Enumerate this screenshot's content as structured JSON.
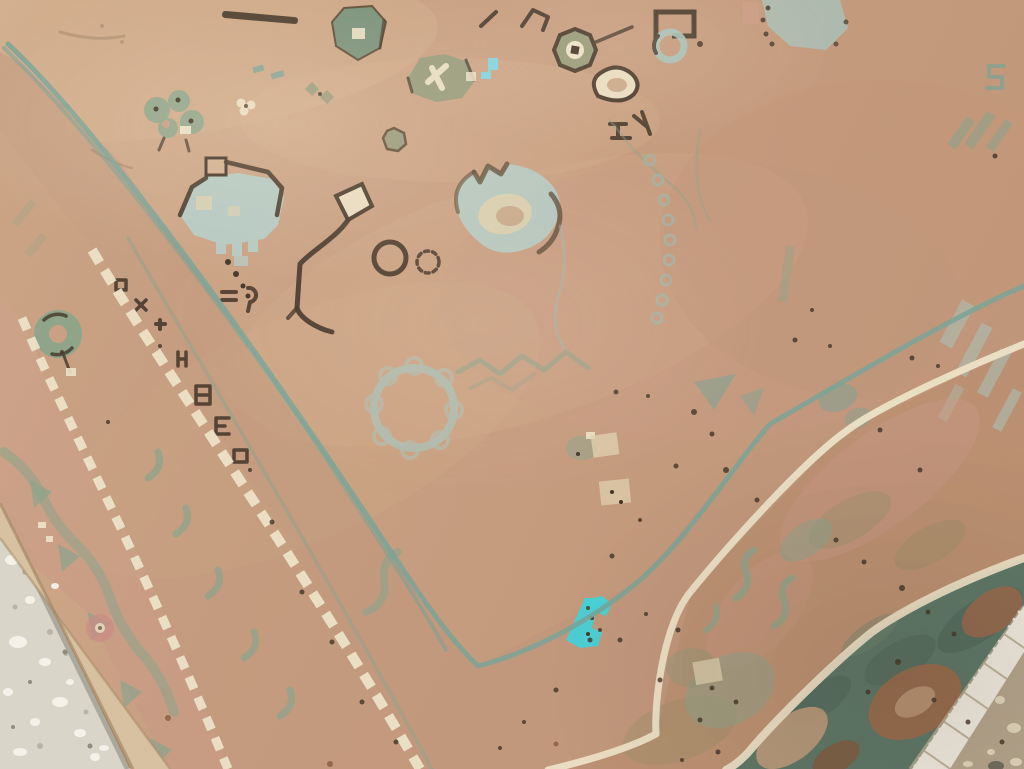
{
  "scene": {
    "type": "photograph",
    "subject": "Antique handwoven tribal rug with camel-tan field, faded sage and blue motifs, teal guard stripes, ivory dashed guard lines, dark teal main border with rust palmettes, white fringe, lying on a speckled stone floor seen at an oblique angle",
    "view": "close oblique crop; rug fills the frame; floor visible at bottom-left corner and bottom-right corner",
    "visible_text": ""
  },
  "palette": {
    "field_a": "#d3b08f",
    "field_b": "#c9a083",
    "field_c": "#c59b7e",
    "field_d": "#bf9577",
    "band_tan": "#c0967b",
    "band_deep": "#b88d6e",
    "band_pink": "#c89a84",
    "binding": "#d8c1a0",
    "binding_shadow": "#a58a66",
    "teal_guard": "#7aa396",
    "sage": "#8ba48b",
    "sage_dark": "#75917b",
    "olive": "#949a7b",
    "olive_soft": "#8e8f68",
    "faded_blue": "#a9c2ba",
    "pale_blue": "#b6c9c2",
    "blue_line": "#9bb9b0",
    "cream": "#ece2c7",
    "cream_soft": "#ddcfae",
    "dark_brown": "#45372a",
    "dark_soft": "#5b4934",
    "turquoise": "#47d0d6",
    "cyan_mark": "#7ed6e6",
    "border_teal": "#5d7767",
    "border_teal_dark": "#4d665a",
    "border_teal_light": "#6e8874",
    "rust": "#9b6a4c",
    "rust_dark": "#875739",
    "tan_leaf": "#c29d7e",
    "floor_gray": "#d9d5c9",
    "chip_white": "#f5f3ea",
    "chip_gray": "#b4b1a4",
    "chip_dark": "#82806e",
    "floor_tan": "#b4a58d",
    "pebble": "#e4dac2",
    "stone": "#6e685a",
    "fringe": "#efeadf",
    "fringe_shadow": "#b9ae97",
    "pink_rose": "#c98e85",
    "salmon": "#cf9f88"
  },
  "rug": {
    "field": {
      "ground": "camel tan, unevenly faded with pink and light washes",
      "motifs": [
        "dark bar",
        "hook glyphs",
        "green hooked hexagon",
        "faded blue palmette",
        "blue ring",
        "octagon medallion",
        "teardrop",
        "olive blob with cream cross",
        "cyan step mark",
        "sage flower cluster",
        "blue cartouche with legs",
        "cream quad with dark zigzag line",
        "dark ring pair",
        "blue tulip palmette",
        "scalloped blue wreath",
        "green zigzag vine",
        "blue bead chain",
        "faded blue streaks at right edge",
        "teal patches",
        "cream patches"
      ]
    },
    "borders": {
      "guard_stripes": "thin teal lines turning a corner near bottom center",
      "dashed_guards": "two ivory dashed lines on the left side",
      "glyph_band": "dark brown small glyphs between dashed guards",
      "sage_band": "sage meander band with rosettes near left edge",
      "mid_band": "tan band with sage S-hooks, palmette cluster and olive mottle",
      "main_border": "dark teal band with rust palmettes and tan leaves at bottom-right",
      "corner_vertex": "border frame corner visible near bottom center"
    },
    "fringe": "white knotted fringe along bottom-right rug end",
    "highlights": [
      "bright turquoise repair patch near bottom center",
      "small cyan mark in upper middle field",
      "pink rosette in lower left border"
    ]
  },
  "floor": {
    "bottom_left": "light gray terrazzo with white chips and gray flecks",
    "bottom_right": "tan concrete with pebbles and a dark stone"
  },
  "decor": {
    "speckles": [
      [
        616,
        392,
        2.5
      ],
      [
        648,
        396,
        2
      ],
      [
        694,
        412,
        3
      ],
      [
        712,
        434,
        2.5
      ],
      [
        676,
        466,
        2.5
      ],
      [
        726,
        470,
        3
      ],
      [
        757,
        500,
        2.5
      ],
      [
        640,
        520,
        2
      ],
      [
        612,
        556,
        2.5
      ],
      [
        590,
        640,
        2.5
      ],
      [
        556,
        690,
        2.5
      ],
      [
        524,
        722,
        2
      ],
      [
        500,
        748,
        2
      ],
      [
        836,
        540,
        2.5
      ],
      [
        864,
        562,
        2.5
      ],
      [
        902,
        588,
        3
      ],
      [
        928,
        612,
        2.5
      ],
      [
        954,
        634,
        2.5
      ],
      [
        898,
        662,
        3
      ],
      [
        868,
        692,
        2.5
      ],
      [
        934,
        700,
        2.5
      ],
      [
        968,
        722,
        2.5
      ],
      [
        1002,
        742,
        2.5
      ],
      [
        718,
        752,
        2.5
      ],
      [
        682,
        760,
        2
      ],
      [
        812,
        310,
        2
      ],
      [
        795,
        340,
        2.5
      ],
      [
        830,
        346,
        2
      ],
      [
        620,
        640,
        2.5
      ],
      [
        660,
        680,
        2.5
      ],
      [
        700,
        720,
        2.5
      ],
      [
        646,
        614,
        2
      ],
      [
        678,
        630,
        2.5
      ],
      [
        880,
        430,
        2.5
      ],
      [
        920,
        470,
        2.5
      ],
      [
        912,
        358,
        2.5
      ],
      [
        938,
        366,
        2
      ],
      [
        160,
        346,
        2
      ],
      [
        250,
        470,
        2
      ],
      [
        272,
        522,
        2.5
      ],
      [
        302,
        592,
        2.5
      ],
      [
        332,
        642,
        2.5
      ],
      [
        362,
        702,
        2.5
      ],
      [
        396,
        742,
        2.5
      ],
      [
        62,
        352,
        2
      ],
      [
        108,
        422,
        2
      ],
      [
        995,
        156,
        2.5
      ],
      [
        588,
        608,
        2
      ],
      [
        600,
        630,
        2
      ]
    ],
    "rust_flecks": [
      [
        330,
        764,
        3
      ],
      [
        556,
        744,
        2.5
      ],
      [
        168,
        718,
        3
      ]
    ],
    "floor_chips": [
      [
        12,
        560,
        7,
        5
      ],
      [
        30,
        600,
        5,
        4
      ],
      [
        18,
        642,
        9,
        6
      ],
      [
        45,
        662,
        6,
        4
      ],
      [
        8,
        692,
        5,
        4
      ],
      [
        60,
        702,
        8,
        5
      ],
      [
        35,
        722,
        5,
        4
      ],
      [
        80,
        733,
        6,
        4
      ],
      [
        20,
        752,
        7,
        4
      ],
      [
        95,
        757,
        5,
        4
      ],
      [
        55,
        586,
        4,
        3
      ],
      [
        70,
        682,
        4,
        3
      ],
      [
        104,
        748,
        5,
        3
      ]
    ],
    "floor_gray_dots": [
      [
        25,
        572,
        3
      ],
      [
        50,
        632,
        3
      ],
      [
        15,
        607,
        2.5
      ],
      [
        40,
        746,
        3
      ],
      [
        86,
        712,
        2.5
      ],
      [
        66,
        654,
        2
      ]
    ],
    "floor_dark_dots": [
      [
        65,
        652,
        2.5
      ],
      [
        30,
        682,
        2
      ],
      [
        90,
        746,
        2.5
      ],
      [
        13,
        727,
        2
      ]
    ],
    "pebbles": [
      [
        1000,
        700,
        5,
        4
      ],
      [
        1014,
        728,
        7,
        5
      ],
      [
        991,
        752,
        4,
        3
      ],
      [
        1016,
        762,
        6,
        4
      ],
      [
        968,
        764,
        5,
        3
      ]
    ],
    "stones": [
      [
        996,
        766,
        8,
        5
      ]
    ],
    "fringe_band": {
      "x1": 1019,
      "y1": 612,
      "x2": 915,
      "y2": 766,
      "teeth": 22,
      "len": 24,
      "dx": 0.82,
      "dy": 0.57
    }
  }
}
